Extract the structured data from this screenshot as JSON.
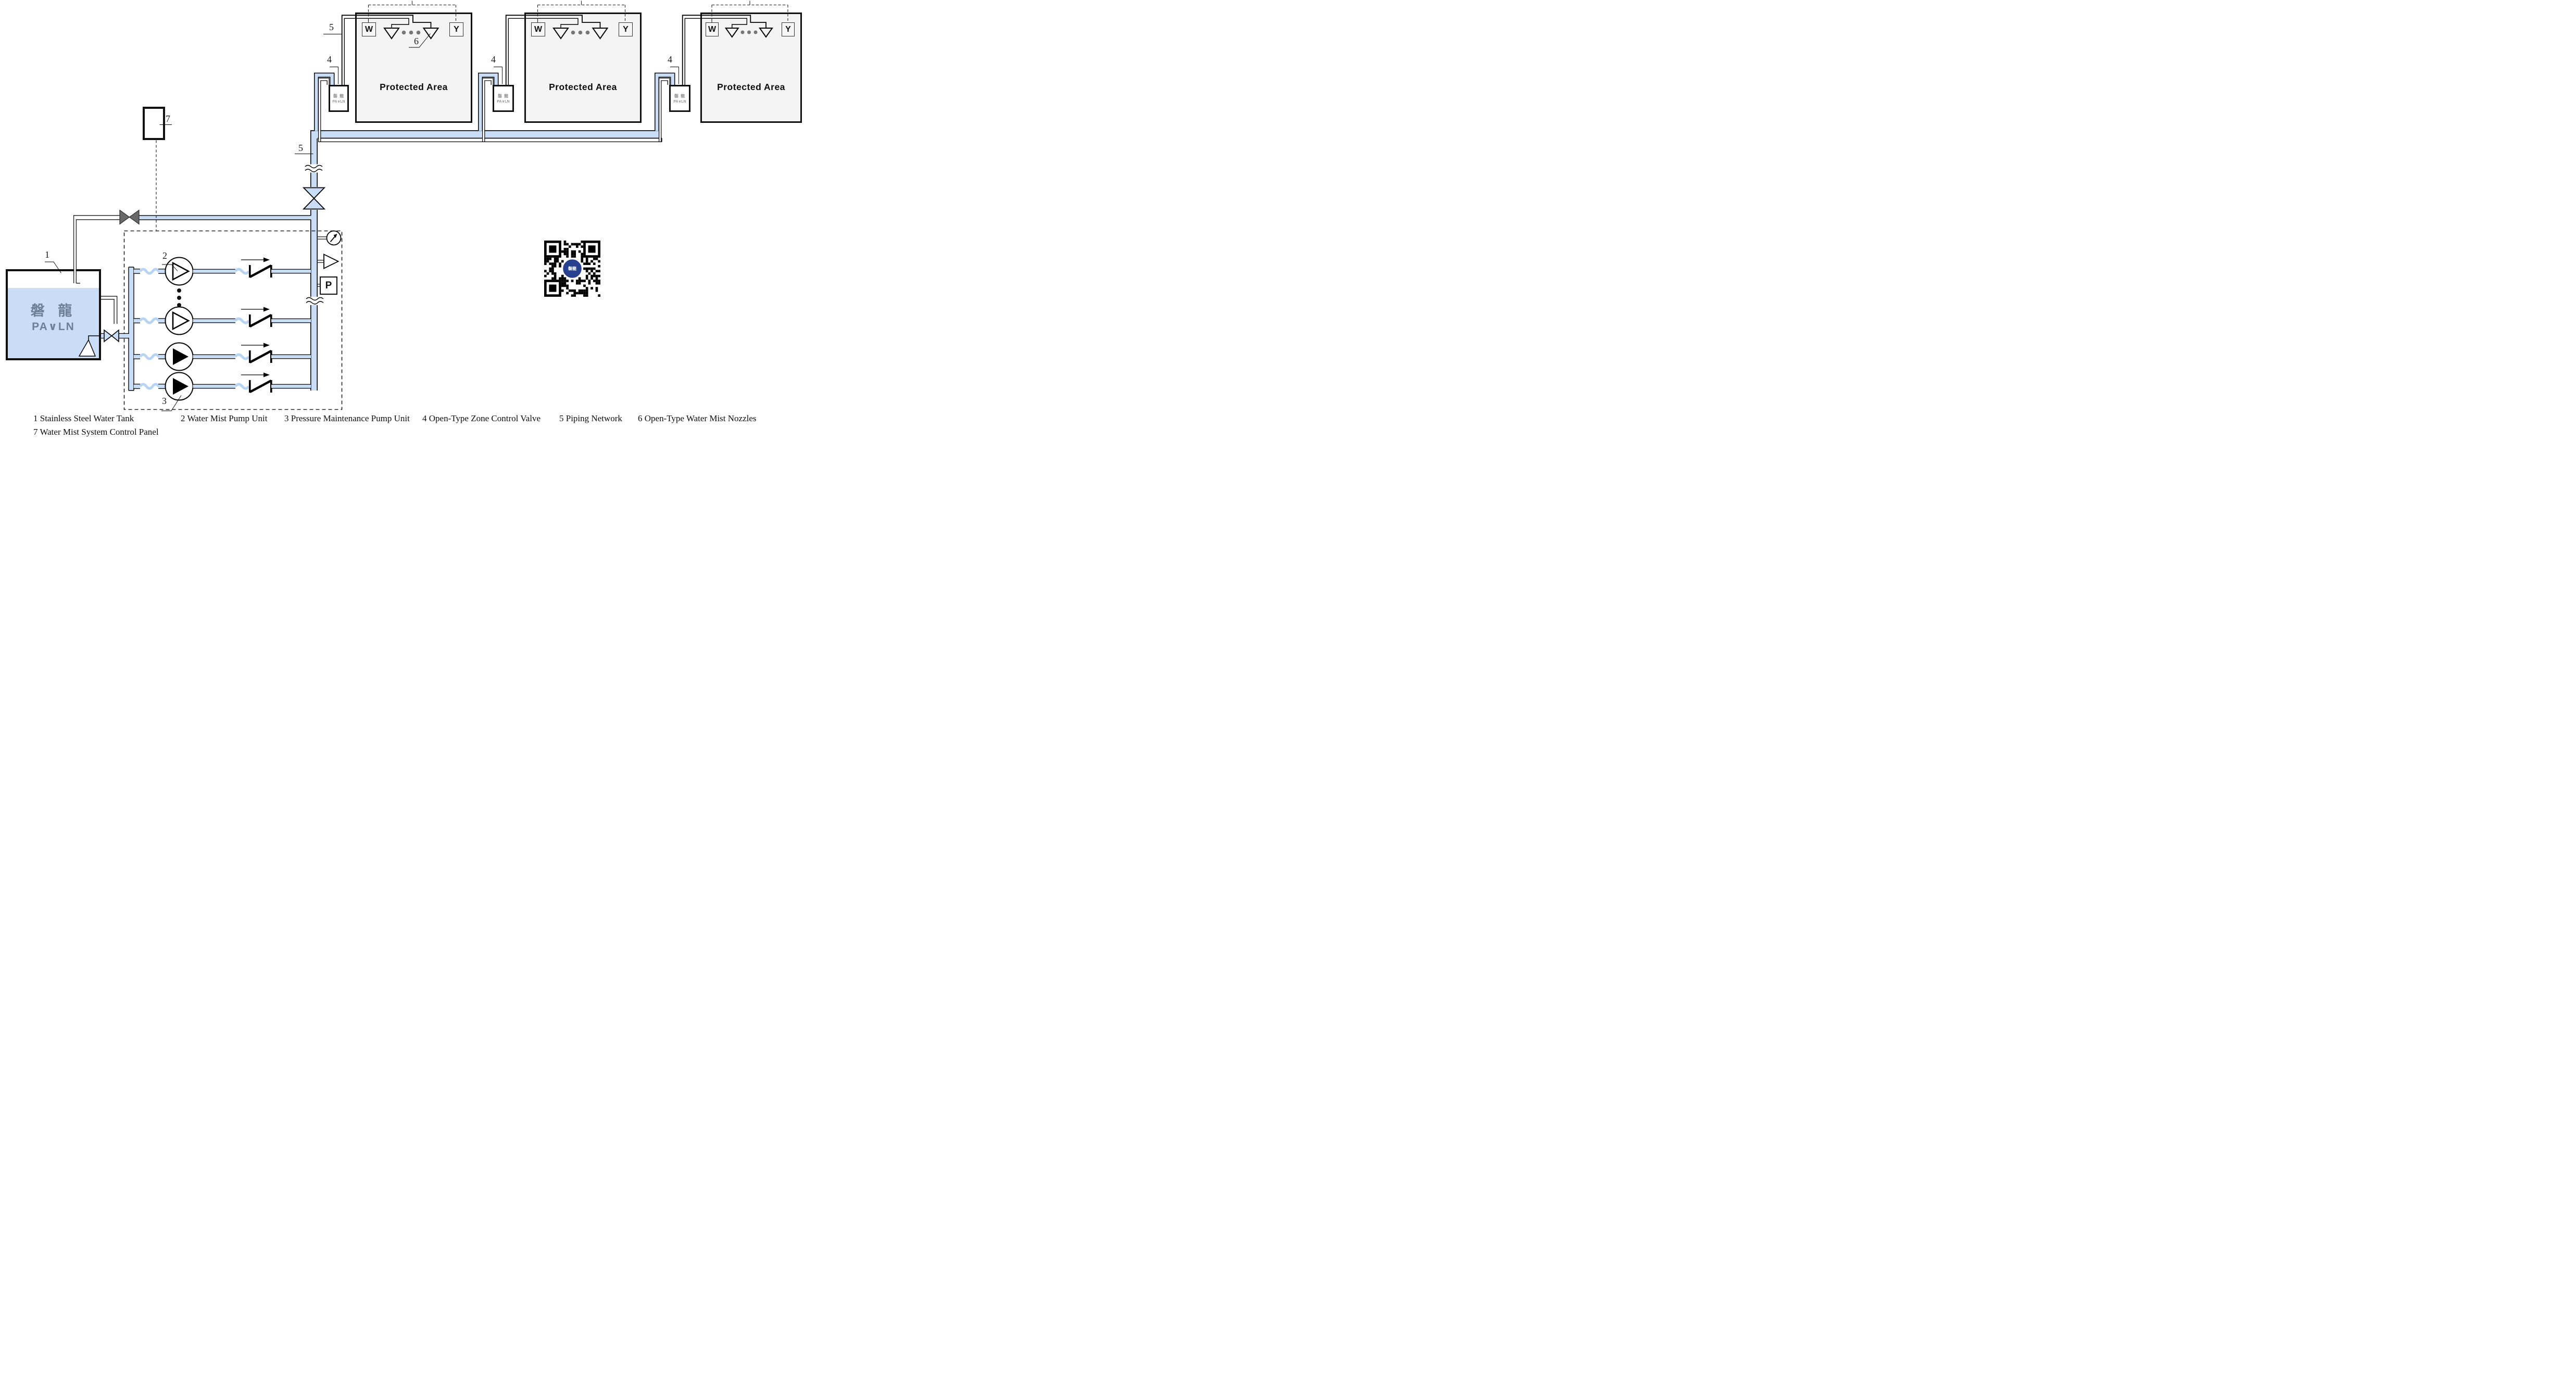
{
  "legend": {
    "row1": [
      "1 Stainless Steel Water Tank",
      "2 Water Mist Pump Unit",
      "3 Pressure Maintenance Pump Unit",
      "4 Open-Type Zone Control Valve",
      "5 Piping Network",
      "6 Open-Type Water Mist Nozzles"
    ],
    "row2": [
      "7 Water Mist System Control Panel"
    ]
  },
  "protected_areas": [
    {
      "title": "Protected Area",
      "w": "W",
      "y": "Y"
    },
    {
      "title": "Protected Area",
      "w": "W",
      "y": "Y"
    },
    {
      "title": "Protected Area",
      "w": "W",
      "y": "Y"
    }
  ],
  "zone_valve": {
    "brand_cn": "磐 龍",
    "brand_en": "PA∨LN"
  },
  "tank": {
    "brand_cn": "磐 龍",
    "brand_en": "PA∨LN"
  },
  "callouts": {
    "tank": "1",
    "mist_pump": "2",
    "jockey_pump": "3",
    "zone_valve_1": "4",
    "zone_valve_2": "4",
    "zone_valve_3": "4",
    "piping_upper": "5",
    "piping_riser": "5",
    "nozzles": "6",
    "control_panel": "7"
  },
  "instruments": {
    "pressure_switch": "P"
  },
  "qr_center_label": "磐龍",
  "colors": {
    "pipe_fill": "#c9def6",
    "protected_area_fill": "#f4f4f4",
    "brand_gray": "#6e8097",
    "qr_blue": "#27418f"
  }
}
